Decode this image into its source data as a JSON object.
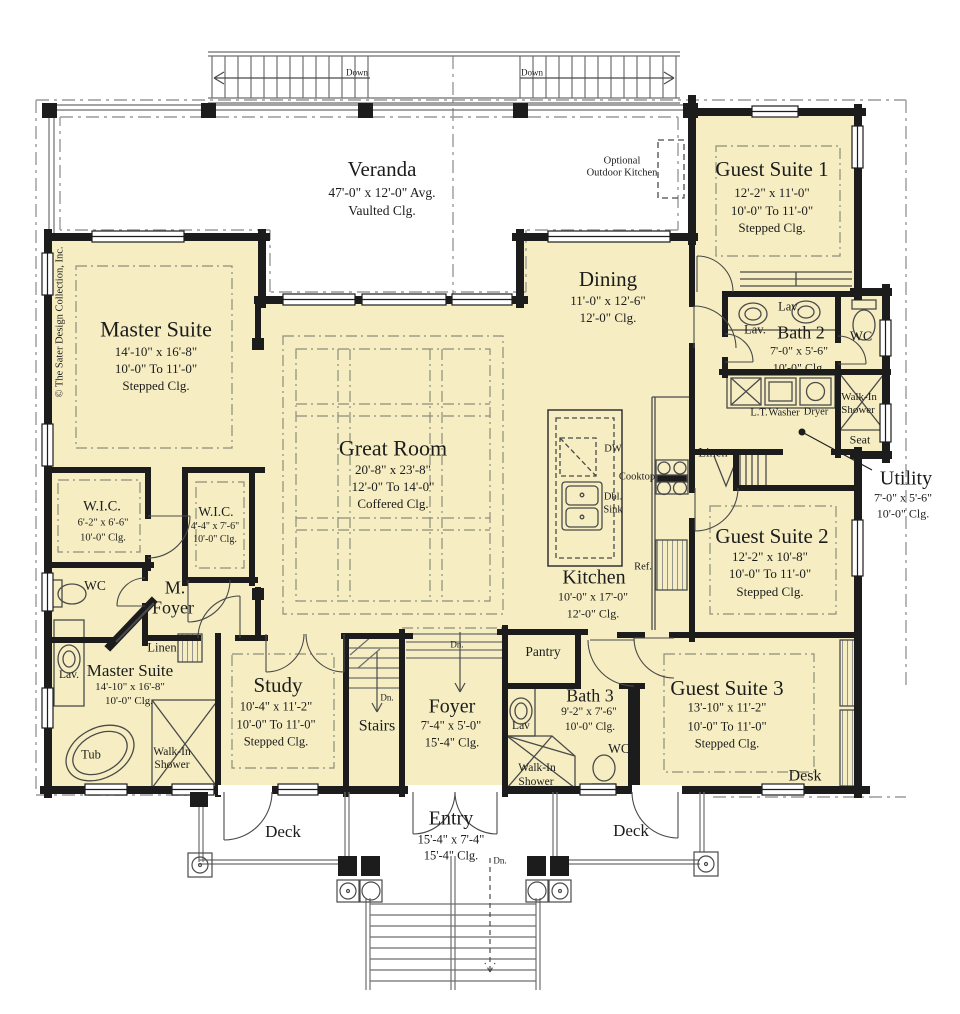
{
  "copyright": "© The Sater Design Collection, Inc.",
  "colors": {
    "floor": "#f6eec2",
    "wall": "#1c1c1c",
    "fixture_line": "#4a4a4a",
    "ceiling_dash": "#8d8d7a"
  },
  "rooms": {
    "veranda": {
      "name": "Veranda",
      "dim": "47'-0\" x 12'-0\" Avg.",
      "clg": "Vaulted Clg."
    },
    "guest_suite_1": {
      "name": "Guest Suite 1",
      "dim": "12'-2\" x 11'-0\"",
      "clg1": "10'-0\" To 11'-0\"",
      "clg2": "Stepped Clg."
    },
    "master_suite": {
      "name": "Master Suite",
      "dim": "14'-10\" x 16'-8\"",
      "clg1": "10'-0\" To 11'-0\"",
      "clg2": "Stepped Clg."
    },
    "dining": {
      "name": "Dining",
      "dim": "11'-0\" x 12'-6\"",
      "clg": "12'-0\" Clg."
    },
    "bath_2": {
      "name": "Bath 2",
      "dim": "7'-0\" x 5'-6\"",
      "clg": "10'-0\" Clg."
    },
    "great_room": {
      "name": "Great Room",
      "dim": "20'-8\" x 23'-8\"",
      "clg1": "12'-0\" To 14'-0\"",
      "clg2": "Coffered Clg."
    },
    "utility": {
      "name": "Utility",
      "dim": "7'-0\" x 5'-6\"",
      "clg": "10'-0\" Clg."
    },
    "guest_suite_2": {
      "name": "Guest Suite 2",
      "dim": "12'-2\" x 10'-8\"",
      "clg1": "10'-0\" To 11'-0\"",
      "clg2": "Stepped Clg."
    },
    "wic_1": {
      "name": "W.I.C.",
      "dim": "6'-2\" x 6'-6\"",
      "clg": "10'-0\" Clg."
    },
    "wic_2": {
      "name": "W.I.C.",
      "dim": "4'-4\" x 7'-6\"",
      "clg": "10'-0\" Clg."
    },
    "kitchen": {
      "name": "Kitchen",
      "dim": "10'-0\" x 17'-0\"",
      "clg": "12'-0\" Clg."
    },
    "m_foyer": {
      "line1": "M.",
      "line2": "Foyer"
    },
    "master_bath": {
      "name": "Master Suite",
      "dim": "14'-10\" x 16'-8\"",
      "clg": "10'-0\" Clg."
    },
    "study": {
      "name": "Study",
      "dim": "10'-4\" x 11'-2\"",
      "clg1": "10'-0\" To 11'-0\"",
      "clg2": "Stepped Clg."
    },
    "stairs": {
      "name": "Stairs"
    },
    "foyer": {
      "name": "Foyer",
      "dim": "7'-4\" x 5'-0\"",
      "clg": "15'-4\" Clg."
    },
    "pantry": {
      "name": "Pantry"
    },
    "bath_3": {
      "name": "Bath 3",
      "dim": "9'-2\" x 7'-6\"",
      "clg": "10'-0\" Clg."
    },
    "guest_suite_3": {
      "name": "Guest Suite 3",
      "dim": "13'-10\" x 11'-2\"",
      "clg1": "10'-0\" To 11'-0\"",
      "clg2": "Stepped Clg."
    },
    "entry": {
      "name": "Entry",
      "dim": "15'-4\" x 7'-4\"",
      "clg": "15'-4\" Clg."
    },
    "deck": {
      "name": "Deck"
    }
  },
  "fixtures": {
    "lav": "Lav.",
    "lav_short": "Lav",
    "wc": "WC",
    "tub": "Tub",
    "seat": "Seat",
    "desk": "Desk",
    "linen": "Linen",
    "walk_in": "Walk-In",
    "shower": "Shower",
    "lt": "L.T.",
    "washer": "Washer",
    "dryer": "Dryer",
    "dw": "DW",
    "dbl": "Dbl.",
    "sink": "Sink",
    "cooktop": "Cooktop",
    "ref": "Ref.",
    "optional_1": "Optional",
    "optional_2": "Outdoor Kitchen"
  },
  "nav": {
    "down": "Down",
    "dn": "Dn."
  }
}
